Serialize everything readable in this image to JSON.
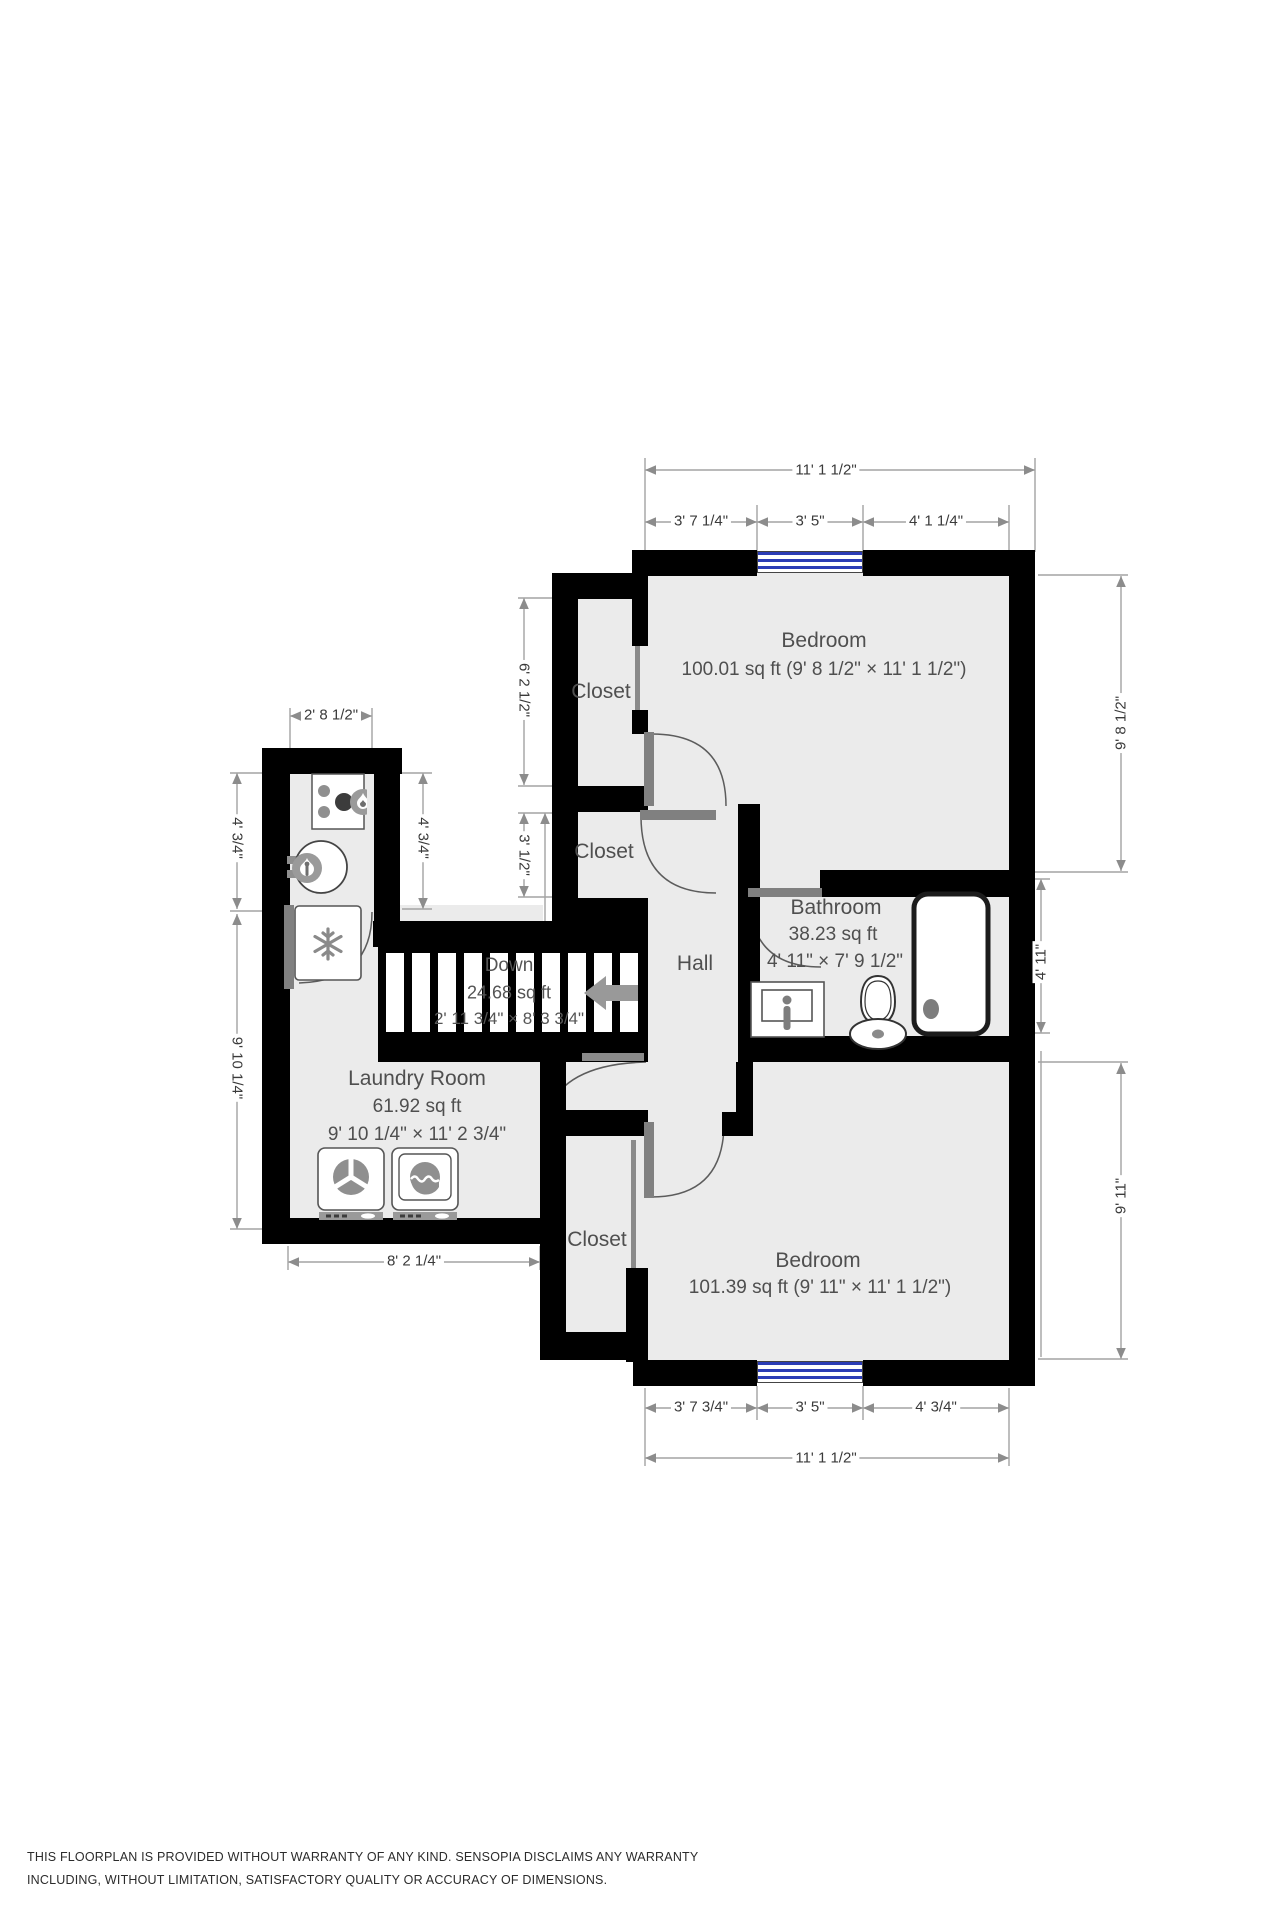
{
  "title": "Floor plan",
  "rooms": {
    "bedroom1": {
      "name": "Bedroom",
      "area": "100.01 sq ft (9' 8 1/2\" × 11' 1 1/2\")"
    },
    "bedroom2": {
      "name": "Bedroom",
      "area": "101.39 sq ft (9' 11\" × 11' 1 1/2\")"
    },
    "bathroom": {
      "name": "Bathroom",
      "area": "38.23 sq ft",
      "dims": "4' 11\" × 7' 9 1/2\""
    },
    "laundry": {
      "name": "Laundry Room",
      "area": "61.92 sq ft",
      "dims": "9' 10 1/4\" × 11' 2 3/4\""
    },
    "hall": {
      "name": "Hall"
    },
    "closet1": {
      "name": "Closet"
    },
    "closet2": {
      "name": "Closet"
    },
    "closet3": {
      "name": "Closet"
    },
    "stairs": {
      "label": "Down",
      "area": "24.68 sq ft",
      "dims": "2' 11 3/4\" × 8' 3 3/4\""
    }
  },
  "dimensions": {
    "top_total": "11' 1 1/2\"",
    "top_seg1": "3' 7 1/4\"",
    "top_seg2": "3' 5\"",
    "top_seg3": "4' 1 1/4\"",
    "right_upper": "9' 8 1/2\"",
    "right_mid": "4' 11\"",
    "right_lower": "9' 11\"",
    "bottom_seg1": "3' 7 3/4\"",
    "bottom_seg2": "3' 5\"",
    "bottom_seg3": "4' 3/4\"",
    "bottom_total": "11' 1 1/2\"",
    "nook_top": "2' 8 1/2\"",
    "nook_left": "4' 3/4\"",
    "nook_right": "4' 3/4\"",
    "laundry_left": "9' 10 1/4\"",
    "laundry_bottom": "8' 2 1/4\"",
    "closet1_height": "6' 2 1/2\"",
    "closet2_height": "3' 1/2\""
  },
  "icons": {
    "stove": "stove-burners-icon",
    "water_heater": "water-heater-flame-icon",
    "freezer": "snowflake-icon",
    "washer": "washer-drum-icon",
    "dryer": "dryer-drum-icon",
    "sink": "sink-faucet-icon",
    "toilet": "toilet-icon",
    "bathtub": "bathtub-icon",
    "stairs_arrow": "left-arrow-icon",
    "window": "window-glазing"
  },
  "colors": {
    "wall": "#000000",
    "floor": "#ebebeb",
    "window_blue": "#2b3cb5",
    "dim_line": "#a3a3a3",
    "label_gray": "#4f4f4f"
  },
  "disclaimer": {
    "line1": "THIS FLOORPLAN IS PROVIDED WITHOUT WARRANTY OF ANY KIND. SENSOPIA DISCLAIMS ANY WARRANTY",
    "line2": "INCLUDING, WITHOUT LIMITATION, SATISFACTORY QUALITY OR ACCURACY OF DIMENSIONS."
  }
}
